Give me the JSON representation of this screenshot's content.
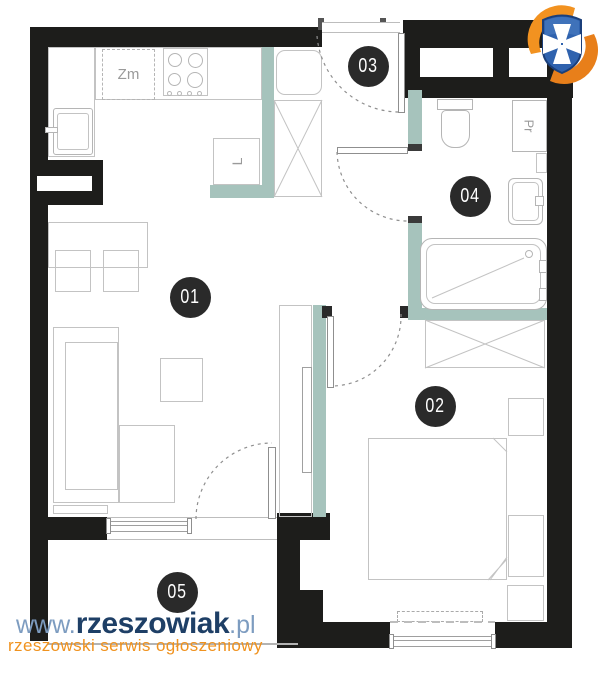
{
  "rooms": [
    {
      "number": "01",
      "name": "living-room-kitchen"
    },
    {
      "number": "02",
      "name": "bedroom"
    },
    {
      "number": "03",
      "name": "entrance-hall"
    },
    {
      "number": "04",
      "name": "bathroom"
    },
    {
      "number": "05",
      "name": "balcony"
    }
  ],
  "appliance_labels": {
    "dishwasher": "Zm",
    "fridge": "L",
    "washing_machine": "Pr"
  },
  "watermark": {
    "prefix": "www.",
    "brand": "rzeszowiak",
    "tld": ".pl",
    "tagline": "rzeszowski serwis ogłoszeniowy"
  },
  "colors": {
    "wall": "#1d1d1b",
    "accent_wall": "#a6c3bc",
    "badge": "#2a2a2a",
    "watermark_blue": "#7d9cc0",
    "watermark_navy": "#1e3f66",
    "watermark_orange": "#f0921e",
    "logo_orange": "#f29220",
    "logo_blue": "#2f62ae"
  }
}
